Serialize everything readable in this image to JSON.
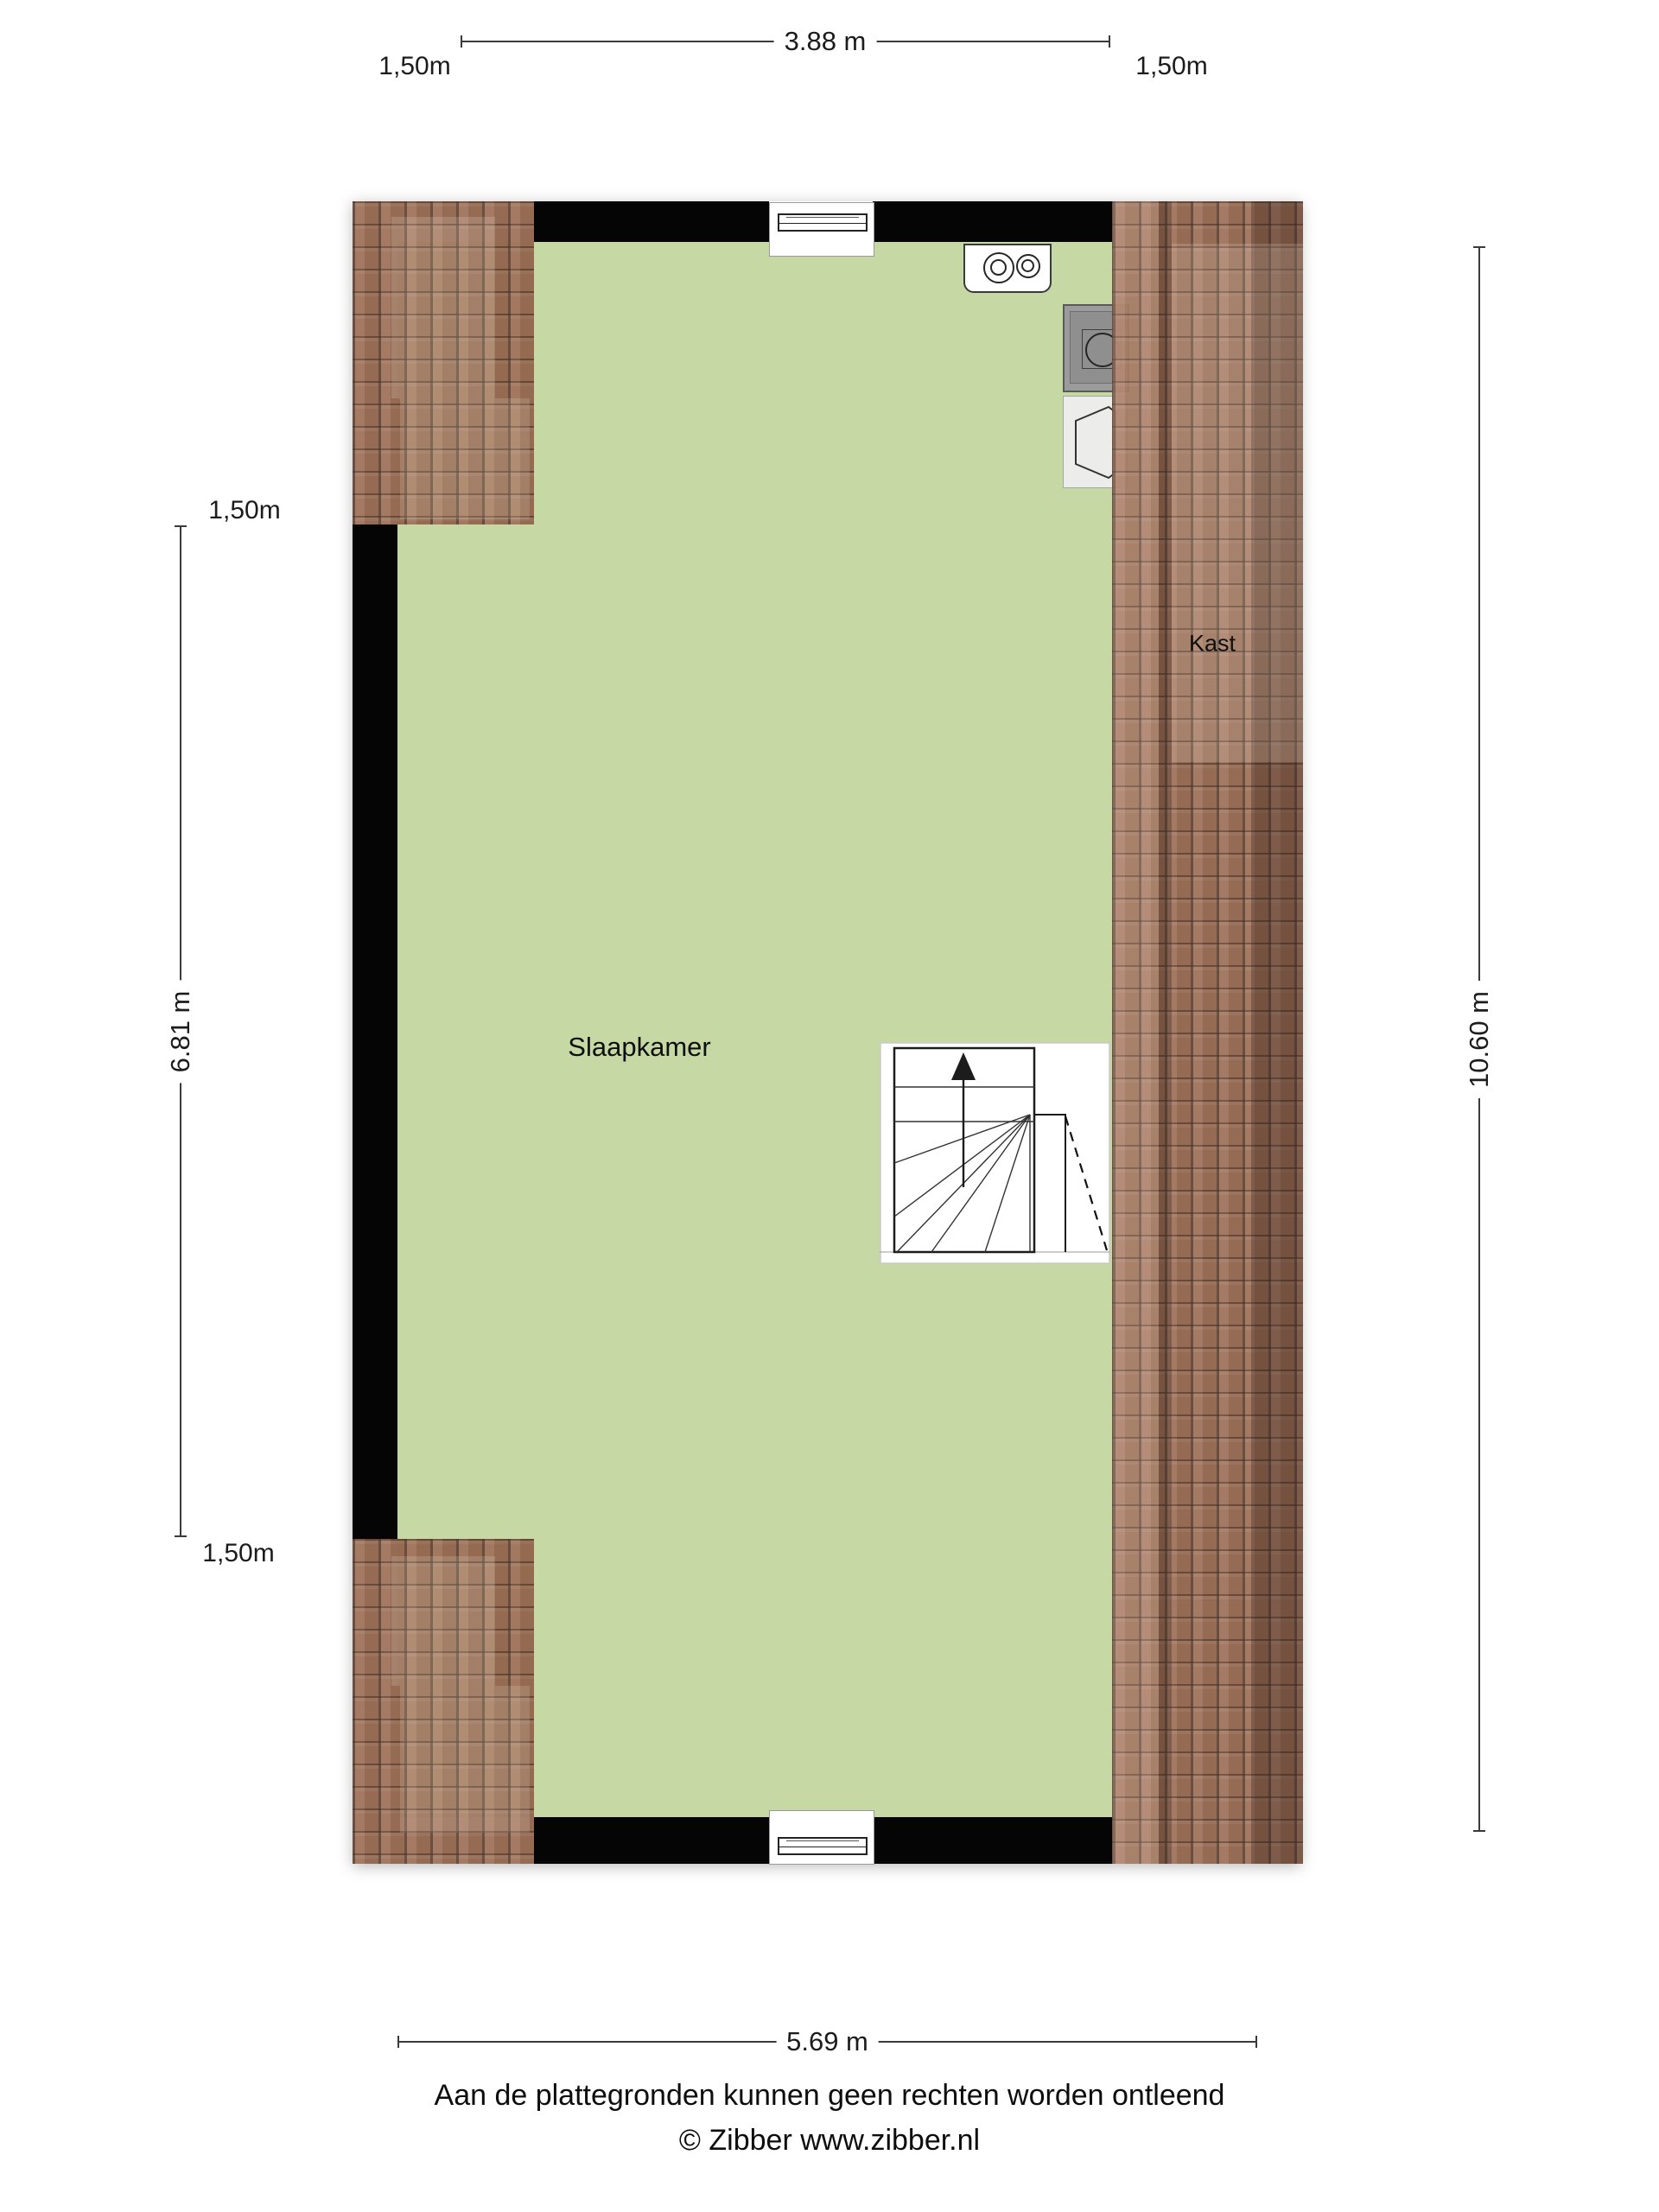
{
  "labels": {
    "slaapkamer": "Slaapkamer",
    "kast": "Kast"
  },
  "dims": {
    "top_left": "1,50m",
    "top_width": "3.88 m",
    "top_right": "1,50m",
    "left_top": "1,50m",
    "left_height": "6.81 m",
    "left_bottom": "1,50m",
    "right_height": "10.60 m",
    "bottom_width": "5.69 m"
  },
  "footer": {
    "disclaimer": "Aan de plattegronden kunnen geen rechten worden ontleend",
    "credit": "© Zibber www.zibber.nl"
  },
  "colors": {
    "floor_green": "#c6d8a4",
    "roof_tile_base": "#9a6b52",
    "roof_tile_dark": "#6a4535",
    "wall_black": "#050505"
  }
}
